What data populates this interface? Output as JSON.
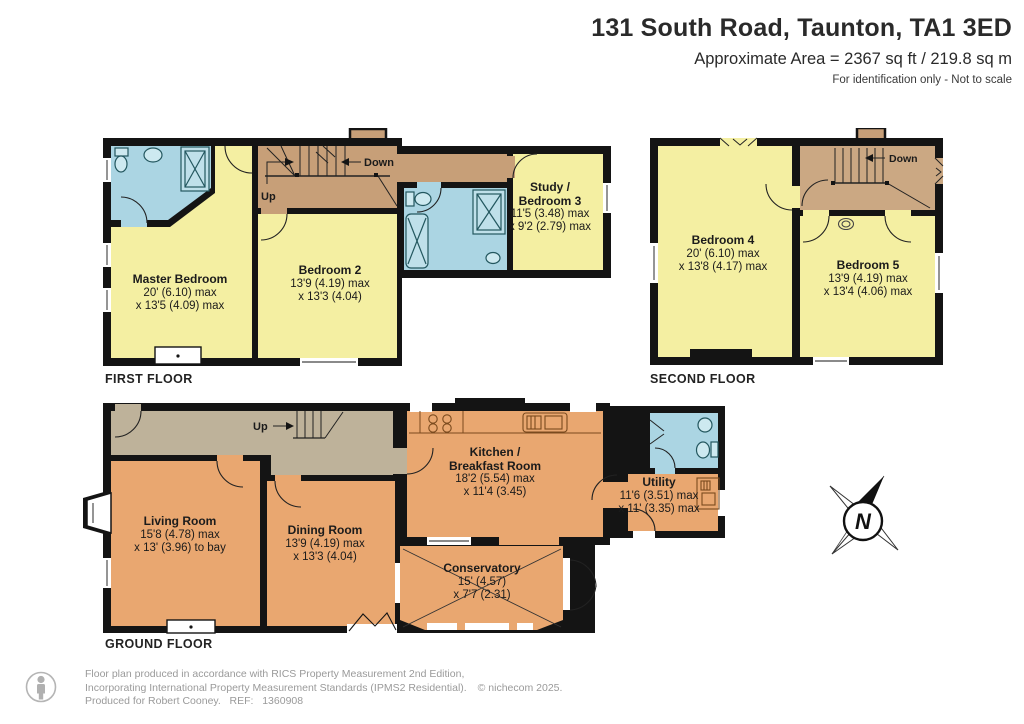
{
  "header": {
    "title": "131 South Road, Taunton, TA1 3ED",
    "area": "Approximate Area = 2367 sq ft / 219.8 sq m",
    "disclaimer": "For identification only - Not to scale"
  },
  "floors": {
    "first": {
      "label": "FIRST FLOOR",
      "rooms": {
        "master": {
          "name": "Master Bedroom",
          "dim1": "20' (6.10) max",
          "dim2": "x 13'5 (4.09) max"
        },
        "bedroom2": {
          "name": "Bedroom 2",
          "dim1": "13'9 (4.19) max",
          "dim2": "x 13'3 (4.04)"
        },
        "study": {
          "name1": "Study /",
          "name2": "Bedroom 3",
          "dim1": "11'5 (3.48) max",
          "dim2": "x 9'2 (2.79) max"
        }
      },
      "stairs": {
        "up": "Up",
        "down": "Down"
      }
    },
    "second": {
      "label": "SECOND FLOOR",
      "rooms": {
        "bedroom4": {
          "name": "Bedroom 4",
          "dim1": "20' (6.10) max",
          "dim2": "x 13'8 (4.17) max"
        },
        "bedroom5": {
          "name": "Bedroom 5",
          "dim1": "13'9 (4.19) max",
          "dim2": "x 13'4 (4.06) max"
        }
      },
      "stairs": {
        "down": "Down"
      }
    },
    "ground": {
      "label": "GROUND FLOOR",
      "rooms": {
        "living": {
          "name": "Living Room",
          "dim1": "15'8 (4.78) max",
          "dim2": "x 13' (3.96) to bay"
        },
        "dining": {
          "name": "Dining Room",
          "dim1": "13'9 (4.19) max",
          "dim2": "x 13'3 (4.04)"
        },
        "kitchen": {
          "name1": "Kitchen /",
          "name2": "Breakfast Room",
          "dim1": "18'2 (5.54) max",
          "dim2": "x 11'4 (3.45)"
        },
        "conservatory": {
          "name": "Conservatory",
          "dim1": "15' (4.57)",
          "dim2": "x 7'7 (2.31)"
        },
        "utility": {
          "name": "Utility",
          "dim1": "11'6 (3.51) max",
          "dim2": "x 11' (3.35) max"
        }
      },
      "stairs": {
        "up": "Up"
      }
    }
  },
  "compass": {
    "north": "N"
  },
  "footer": {
    "line1": "Floor plan produced in accordance with RICS Property Measurement 2nd Edition,",
    "line2": "Incorporating International Property Measurement Standards (IPMS2 Residential).",
    "copyright": "© nichecom 2025.",
    "line3": "Produced for Robert Cooney.   REF:   1360908"
  },
  "colors": {
    "wall": "#141414",
    "bedroom_yellow": "#F4EFA2",
    "bathroom_blue": "#ABD5E3",
    "stairs_brown": "#C79F78",
    "hall_taupe": "#BEB29A",
    "ground_orange": "#E9A770",
    "footer_grey": "#9a9a9a"
  }
}
